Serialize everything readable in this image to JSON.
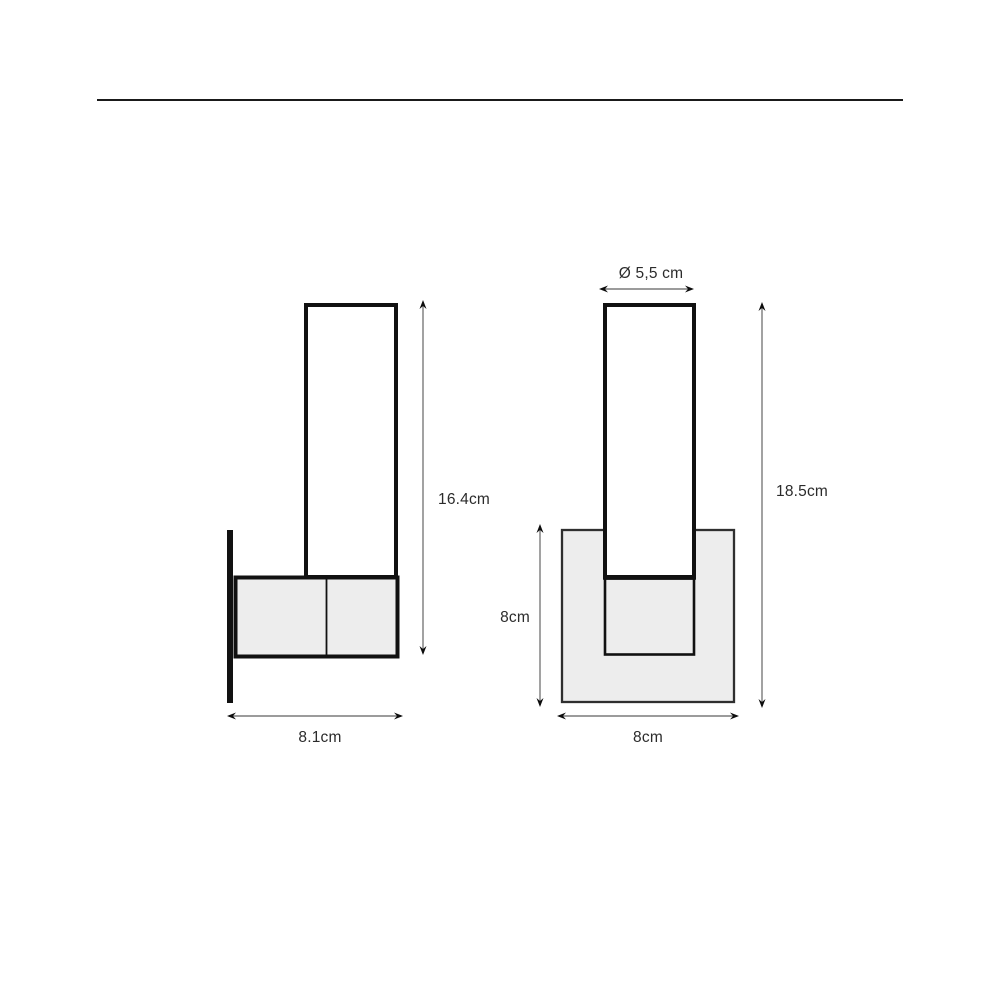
{
  "views": {
    "side": {
      "dimensions": {
        "height": "16.4cm",
        "width": "8.1cm"
      }
    },
    "front": {
      "dimensions": {
        "diameter": "Ø 5,5 cm",
        "height": "18.5cm",
        "plate_height": "8cm",
        "plate_width": "8cm"
      }
    }
  },
  "colors": {
    "background": "#ffffff",
    "outline": "#111111",
    "panel_fill": "#ededed",
    "dimension_line": "#7a7a7a",
    "arrowhead": "#0d0d0d",
    "text": "#2b2b2b",
    "divider": "#1a1a1a"
  }
}
